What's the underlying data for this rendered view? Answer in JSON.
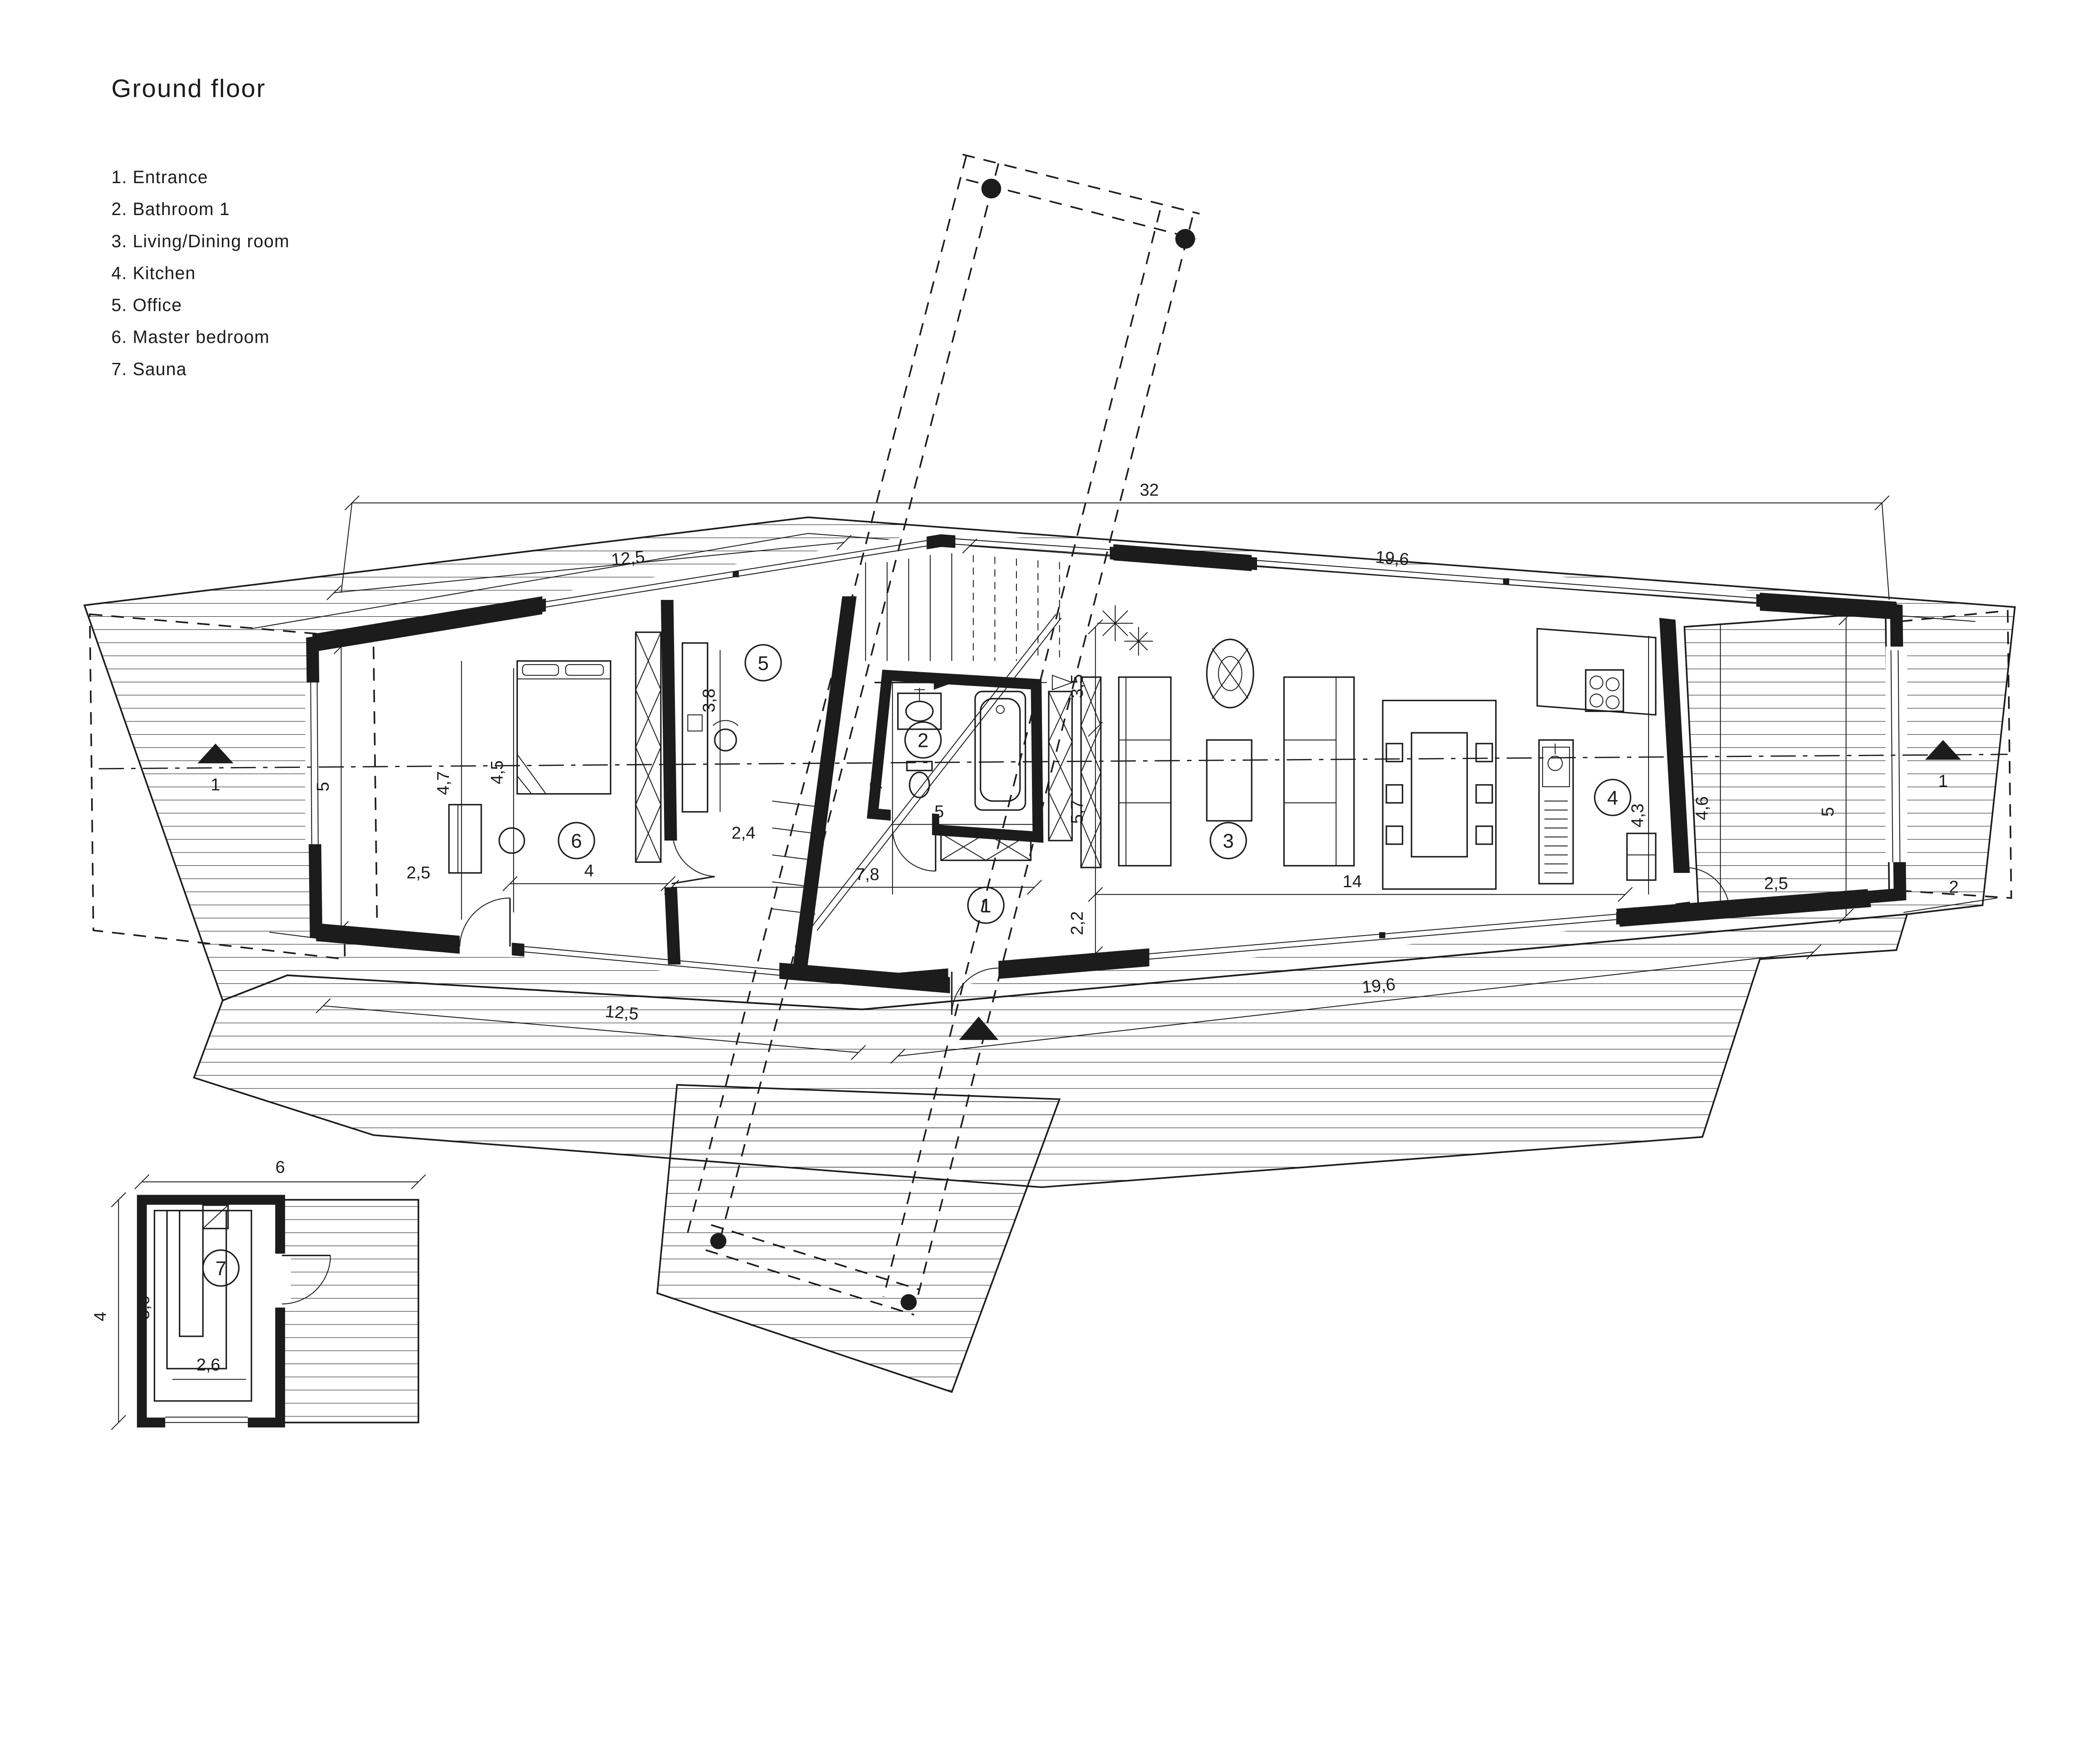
{
  "title": "Ground floor",
  "legend": {
    "items": [
      "1. Entrance",
      "2. Bathroom 1",
      "3. Living/Dining room",
      "4. Kitchen",
      "5. Office",
      "6. Master bedroom",
      "7. Sauna"
    ]
  },
  "colors": {
    "ink": "#1c1c1c",
    "paper": "#ffffff"
  },
  "plan": {
    "rooms": {
      "entrance": "1",
      "bathroom": "2",
      "living": "3",
      "kitchen": "4",
      "office": "5",
      "bedroom": "6",
      "sauna": "7"
    },
    "section_marker": "1",
    "dims": {
      "top_overall": "32",
      "top_left": "12,5",
      "top_right": "19,6",
      "left_height": "5",
      "left_offset": "2",
      "bedroom_window": "4,7",
      "bedroom_depth": "4,5",
      "bedroom_door": "2,5",
      "bedroom_width": "4",
      "office_depth": "3,8",
      "office_door": "2,4",
      "hall_length": "7",
      "bath_width": "5",
      "hall_width": "7,8",
      "living_top": "3,5",
      "living_mid": "5,7",
      "living_bottom": "2,2",
      "living_length": "14",
      "kitchen_depth": "4,3",
      "terrace_width": "4,6",
      "right_height": "5",
      "terrace_door": "2,5",
      "right_offset": "2",
      "bottom_left": "12,5",
      "bottom_right": "19,6"
    },
    "sauna_dims": {
      "width": "6",
      "depth": "4",
      "bench_length": "3,6",
      "bench_width": "2,6"
    }
  }
}
